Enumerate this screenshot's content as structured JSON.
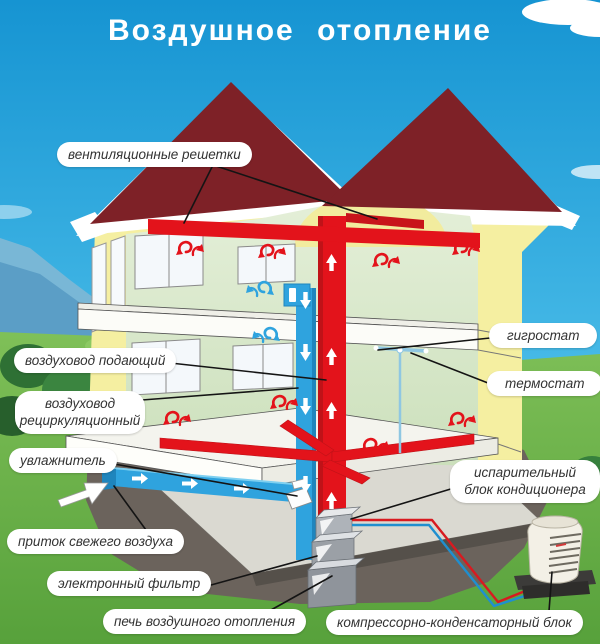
{
  "title": "Воздушное отопление",
  "labels": {
    "vent_grilles": "вентиляционные решетки",
    "supply_duct": "воздуховод подающий",
    "recirc_duct": "воздуховод рециркуляционный",
    "humidifier": "увлажнитель",
    "fresh_air_intake": "приток свежего воздуха",
    "electronic_filter": "электронный фильтр",
    "furnace": "печь воздушного отопления",
    "hygrostat": "гигростат",
    "thermostat": "термостат",
    "evaporator_unit": "испарительный блок кондиционера",
    "compressor_unit": "компрессорно-конденсаторный блок"
  },
  "colors": {
    "sky_top": "#1694D2",
    "sky_bottom": "#8FD8F2",
    "grass_top": "#7FC058",
    "grass_bottom": "#57A13B",
    "roof": "#7E2127",
    "wall": "#F5EFA1",
    "interior": "#DCE9CE",
    "duct_hot": "#E3131B",
    "duct_cold": "#2FA3DE",
    "earth": "#6B635C",
    "label_bg": "#FFFFFF",
    "label_text": "#333333",
    "title_text": "#FFFFFF",
    "leader": "#141414"
  }
}
